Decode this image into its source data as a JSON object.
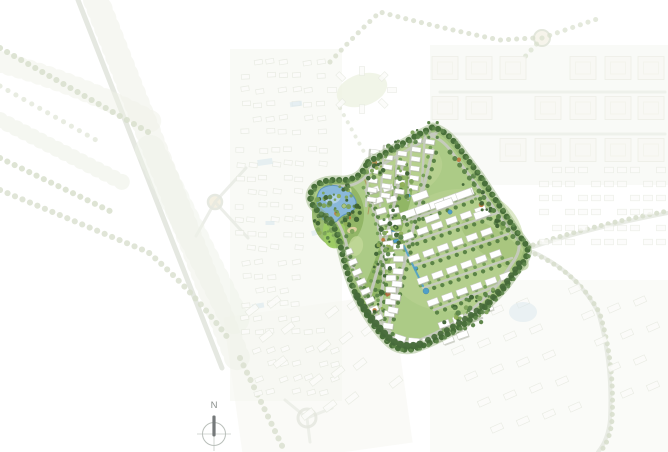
{
  "compass": {
    "label": "N"
  },
  "regions": {
    "development_parcel": "central landscaped residential development parcel",
    "lake_park": "lake and park area on west lobe of parcel",
    "central_green_spine": "central linear park with swimming pools and water channel",
    "villa_rows": "rows of white villas and row-houses",
    "surrounding_context": "faded surrounding master-plan neighborhoods, roads and tree-lined avenues",
    "north_arrow": "compass rose with north label"
  },
  "palette": {
    "background": "#ffffff",
    "context_tint": "#f4f6ef",
    "faded_road": "#e4e7df",
    "faded_tree": "#d8dfcd",
    "faded_foliage": "#edf1e6",
    "faded_building_fill": "#fcfcfa",
    "faded_building_stroke": "#e7eae1",
    "faded_block_fill": "#f8f8f4",
    "faded_block_stroke": "#eaece3",
    "faded_pool": "#d9e7ee",
    "site_base_green": "#accb86",
    "site_base_light": "#bcd494",
    "site_park_green": "#8fb463",
    "lawn_bright": "#9ccb62",
    "lawn_light": "#cfe0a6",
    "tree_dark": "#3f6334",
    "tree_medium": "#5d854a",
    "tree_light": "#7da35a",
    "tree_olive": "#8fae56",
    "tree_border": "#49703a",
    "tree_border_glow": "#86a86a",
    "road_gray": "#c6cabf",
    "building_white": "#ffffff",
    "building_stroke": "#c9ccc3",
    "building_shadow": "#a9ad9f",
    "lake_blue": "#8ab8da",
    "lake_edge": "#5f94bc",
    "lake_highlight": "#b6d3e9",
    "pool_blue": "#4f9fc8",
    "sand_tan": "#e6d4a6",
    "path_brown": "#b08350",
    "accent_terracotta": "#b0643c",
    "compass_text": "#8a8f8c",
    "compass_ring": "#b9bfba",
    "compass_needle": "#75797a"
  }
}
